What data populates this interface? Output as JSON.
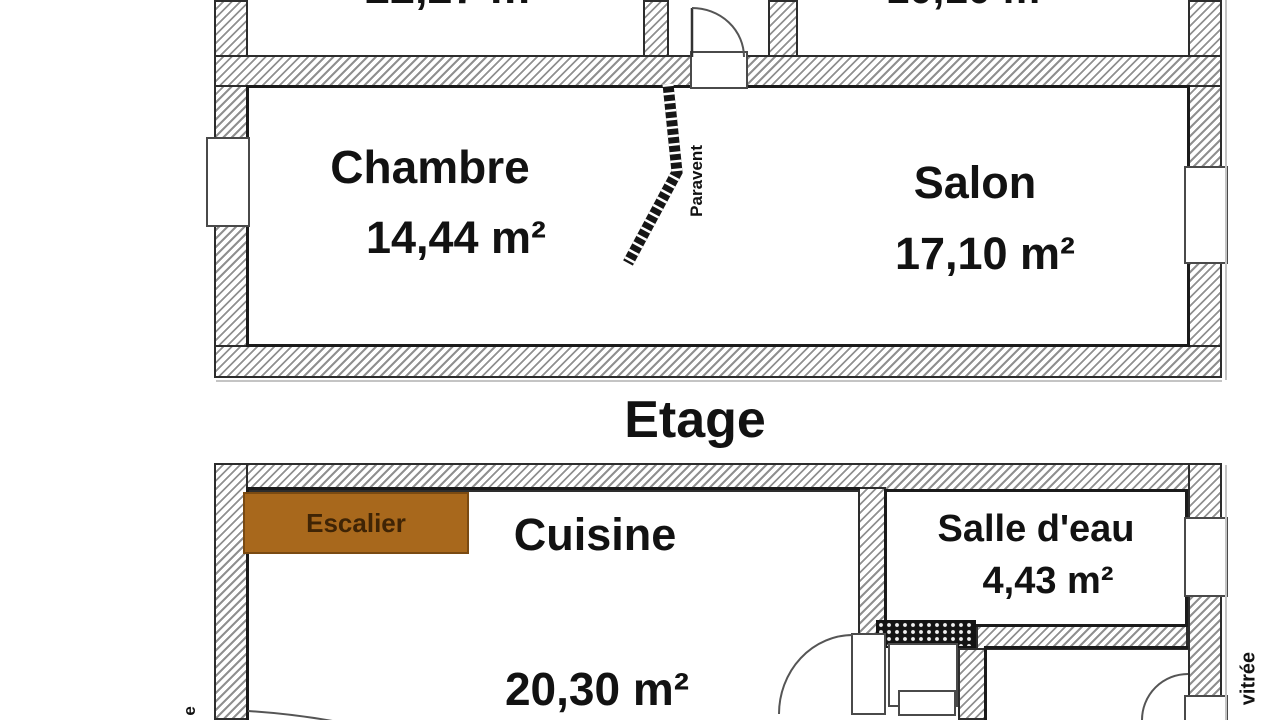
{
  "plan": {
    "floor_title": "Etage",
    "upper_floor": {
      "partial_area_left": "22,27 m²",
      "partial_area_right": "10,10 m²",
      "chambre": {
        "name": "Chambre",
        "area": "14,44 m²"
      },
      "salon": {
        "name": "Salon",
        "area": "17,10 m²"
      },
      "paravent_label": "Paravent"
    },
    "lower_floor": {
      "escalier_label": "Escalier",
      "cuisine": {
        "name": "Cuisine",
        "area": "20,30 m²"
      },
      "salle_eau": {
        "name": "Salle d'eau",
        "area": "4,43 m²"
      },
      "vitree_label": "vitrée",
      "edge_fragment": "e"
    },
    "colors": {
      "escalier_fill": "#a8681c",
      "escalier_border": "#7a4a12",
      "escalier_text": "#3f2405",
      "wall_hatch": "#909090",
      "outline": "#1b1b1b",
      "text": "#121212"
    }
  }
}
